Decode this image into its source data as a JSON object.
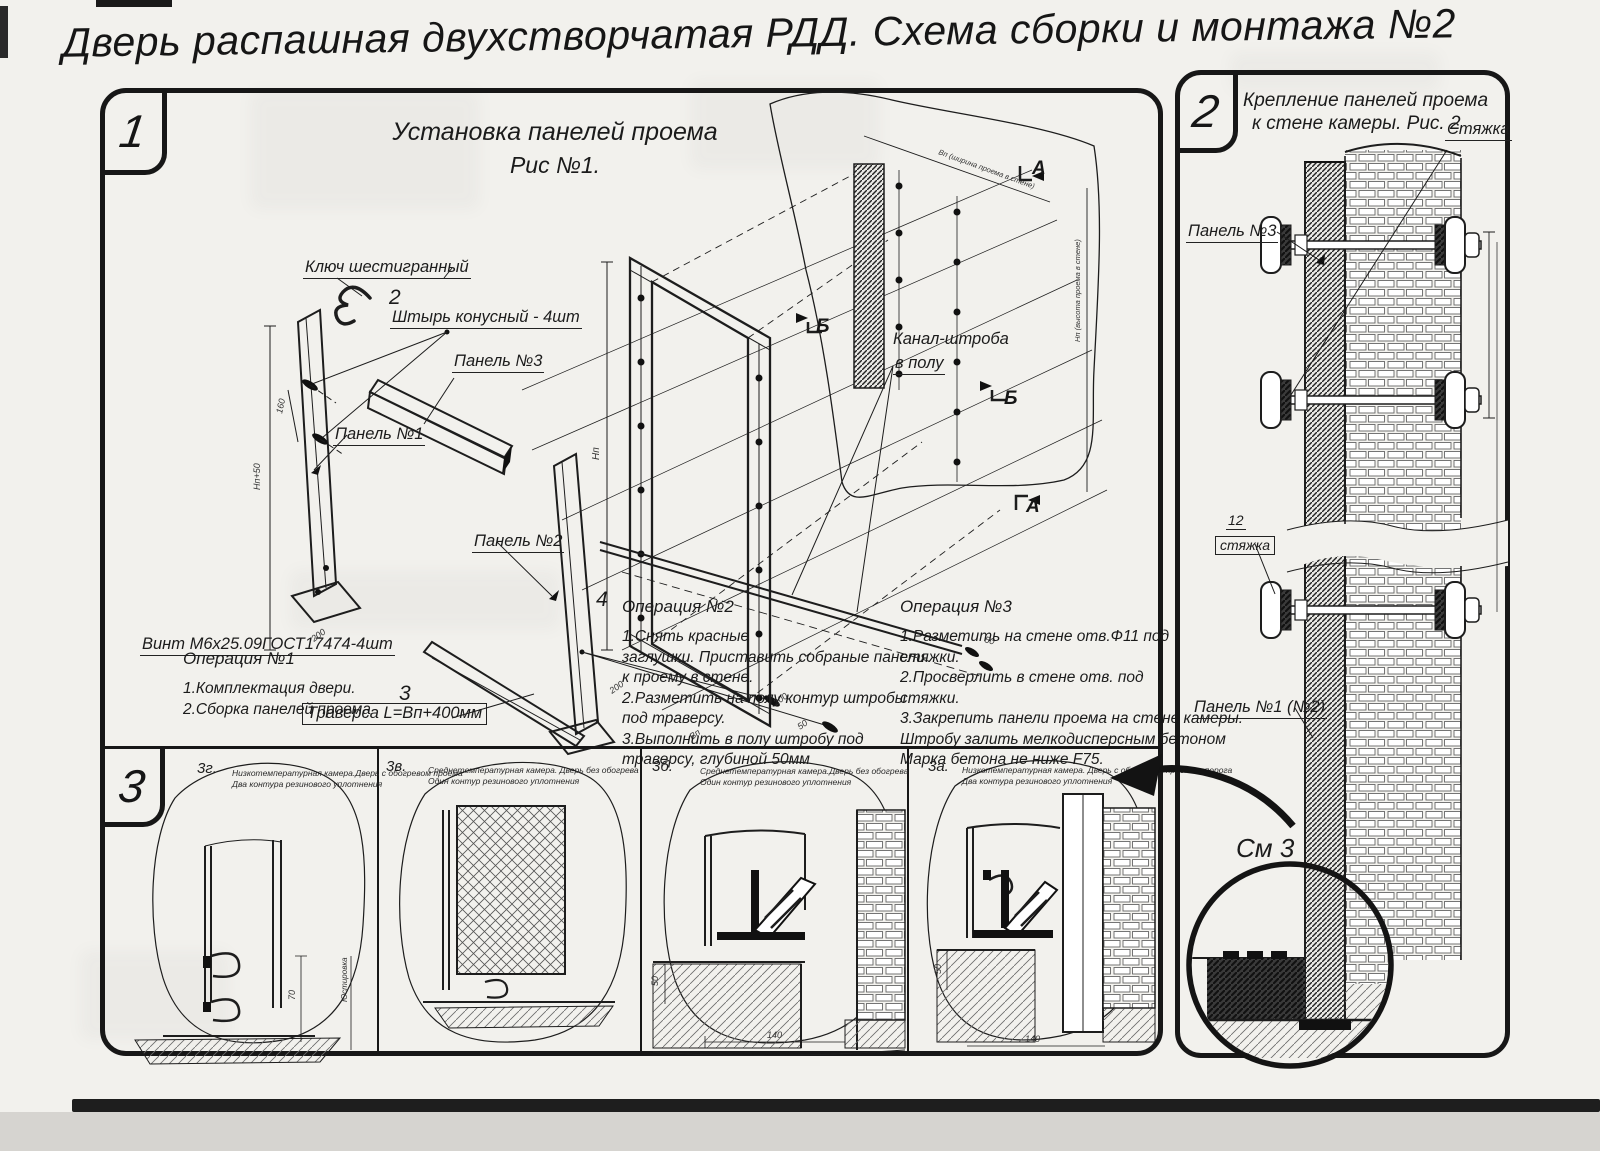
{
  "title": "Дверь распашная двухстворчатая РДД.  Схема сборки и монтажа №2",
  "colors": {
    "paper": "#f2f1ed",
    "ink": "#171717"
  },
  "section1": {
    "number": "1",
    "heading_line1": "Установка панелей проема",
    "heading_line2": "Рис №1.",
    "labels": {
      "hex_key": "Ключ шестигранный",
      "pin_num": "2",
      "pin": "Штырь конусный - 4шт",
      "panel3": "Панель №3",
      "panel1": "Панель №1",
      "panel2": "Панель №2",
      "screw_num": "4",
      "screw": "Винт М6х25.09ГОСТ17474-4шт",
      "traverse_num": "3",
      "traverse": "Траверса  L=Вп+400мм",
      "channel_line1": "Канал-штроба",
      "channel_line2": "в полу",
      "marker_a": "А",
      "marker_b": "Б"
    },
    "dims": {
      "d200": "200",
      "d160": "160",
      "d50": "50",
      "hp": "Hп",
      "vp": "Вп",
      "hp50": "Hп+50",
      "w_note": "Вп (ширина проема в стене)",
      "h_note": "Нп (высота проема в стене)"
    },
    "op1": {
      "title": "Операция №1",
      "lines": [
        "1.Комплектация двери.",
        "2.Сборка панелей проема"
      ]
    },
    "op2": {
      "title": "Операция №2",
      "lines": [
        "1.Снять красные",
        "заглушки. Приставить собраные панели",
        "к проему в стене.",
        "2.Разметить на полу контур штробы",
        "под траверсу.",
        "3.Выполнить в полу штробу под",
        "траверсу, глубиной 50мм"
      ]
    },
    "op3": {
      "title": "Операция №3",
      "lines": [
        "1.Разметить на стене отв.Ф11 под",
        "стяжки.",
        "2.Просверлить в стене отв.  под",
        "стяжки.",
        "3.Закрепить панели проема на стене камеры.",
        "Штробу залить мелкодисперсным бетоном",
        "Марка бетона не ниже  F75."
      ]
    }
  },
  "section2": {
    "number": "2",
    "heading_line1": "Крепление панелей проема",
    "heading_line2": "к стене камеры. Рис. 2",
    "labels": {
      "tie": "Стяжка",
      "panel3": "Панель №3",
      "tie_num": "12",
      "tie_small": "стяжка",
      "panel12": "Панель №1 (№2)",
      "see3": "См 3"
    }
  },
  "section3": {
    "number": "3",
    "views": [
      {
        "id": "3г.",
        "cap1": "Низкотемпературная камера.Дверь с обогревом проема",
        "cap2": "Два контура резинового уплотнения",
        "dim": "70",
        "note": "Юстировка"
      },
      {
        "id": "3в.",
        "cap1": "Среднетемпературная камера. Дверь без обогрева",
        "cap2": "Один контур резинового уплотнения"
      },
      {
        "id": "3б.",
        "cap1": "Среднетемпературная камера.Дверь без обогрева",
        "cap2": "Один контур резинового уплотнения",
        "dim_v": "50",
        "dim_h": "140"
      },
      {
        "id": "3а.",
        "cap1": "Низкотемпературная камера. Дверь с обогревом проема и порога",
        "cap2": "Два контура резинового уплотнения",
        "dim_v": "50",
        "dim_h": "140"
      }
    ]
  }
}
